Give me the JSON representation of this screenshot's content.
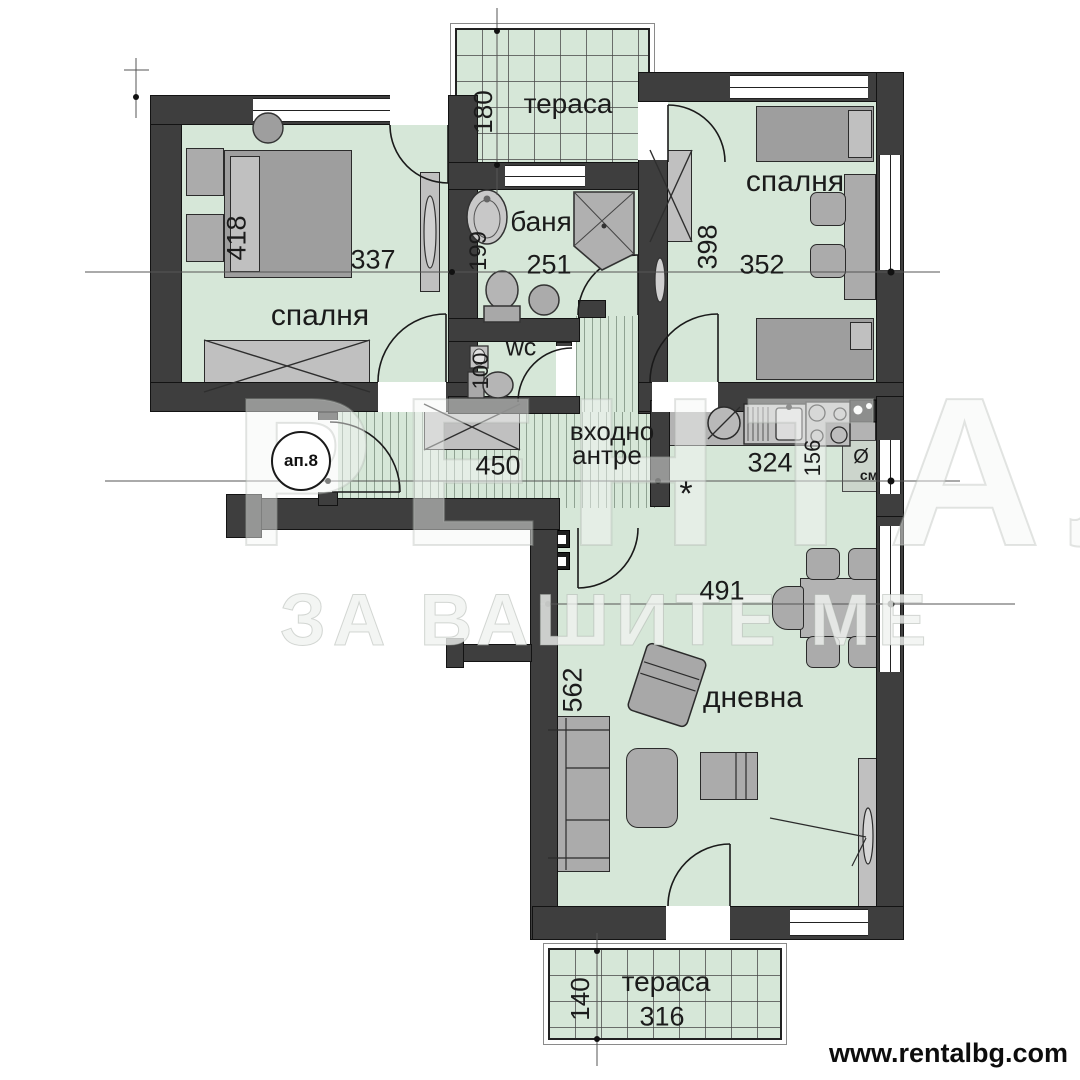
{
  "plan": {
    "badge": "ап.8",
    "watermark_line1": "РЕНТАЛ",
    "watermark_line2": "ЗА ВАШИТЕ МЕ",
    "website": "www.rentalbg.com",
    "rooms": {
      "bedroom_left": {
        "label": "спалня",
        "width": "337",
        "height": "418"
      },
      "bathroom": {
        "label": "баня",
        "width": "251",
        "height": "199"
      },
      "wc": {
        "label": "wc",
        "height": "100"
      },
      "bedroom_right": {
        "label": "спалня",
        "width": "352",
        "height": "398"
      },
      "terrace_top": {
        "label": "тераса",
        "depth": "180"
      },
      "hall": {
        "label1": "входно",
        "label2": "антре",
        "width": "450"
      },
      "kitchen": {
        "width": "324",
        "depth": "156",
        "washer_symbol": "Ø",
        "washer_label": "см",
        "gas_symbol": "*"
      },
      "living": {
        "label": "дневна",
        "width": "491",
        "height": "562"
      },
      "terrace_bottom": {
        "label": "тераса",
        "width": "316",
        "depth": "140"
      }
    },
    "colors": {
      "room_fill": "#d6e7d8",
      "wall": "#3e3e3e",
      "furniture": "#ababab"
    }
  }
}
